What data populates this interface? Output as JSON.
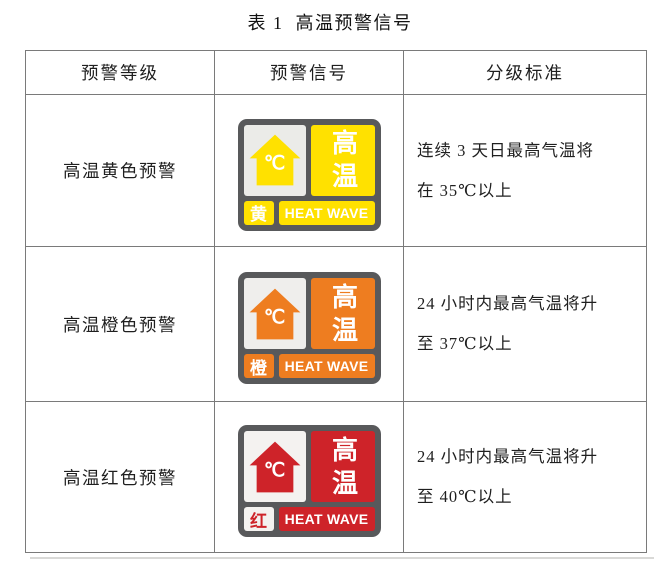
{
  "page": {
    "title": "表 1  高温预警信号"
  },
  "table": {
    "headers": [
      "预警等级",
      "预警信号",
      "分级标准"
    ],
    "rows": [
      {
        "level": "高温黄色预警",
        "criteria_line1": "连续 3 天日最高气温将",
        "criteria_line2": "在 35℃以上",
        "signal": {
          "variant": "yellow",
          "main_color": "#FFE100",
          "degree_label": "℃",
          "vertical_label": "高温",
          "corner_label": "黄",
          "banner_label": "HEAT WAVE"
        }
      },
      {
        "level": "高温橙色预警",
        "criteria_line1": "24 小时内最高气温将升",
        "criteria_line2": "至 37℃以上",
        "signal": {
          "variant": "orange",
          "main_color": "#EE7D20",
          "degree_label": "℃",
          "vertical_label": "高温",
          "corner_label": "橙",
          "banner_label": "HEAT WAVE"
        }
      },
      {
        "level": "高温红色预警",
        "criteria_line1": "24 小时内最高气温将升",
        "criteria_line2": "至 40℃以上",
        "signal": {
          "variant": "red",
          "main_color": "#CE2329",
          "degree_label": "℃",
          "vertical_label": "高温",
          "corner_label": "红",
          "banner_label": "HEAT WAVE"
        }
      }
    ]
  },
  "colors": {
    "sign_frame_gray": "#58595B",
    "table_border_gray": "#7A7A7A",
    "house_panel_gray": "#EBEBE8",
    "yellow": "#FFE100",
    "orange": "#EE7D20",
    "red": "#CE2329",
    "text": "#1F1F1F"
  }
}
